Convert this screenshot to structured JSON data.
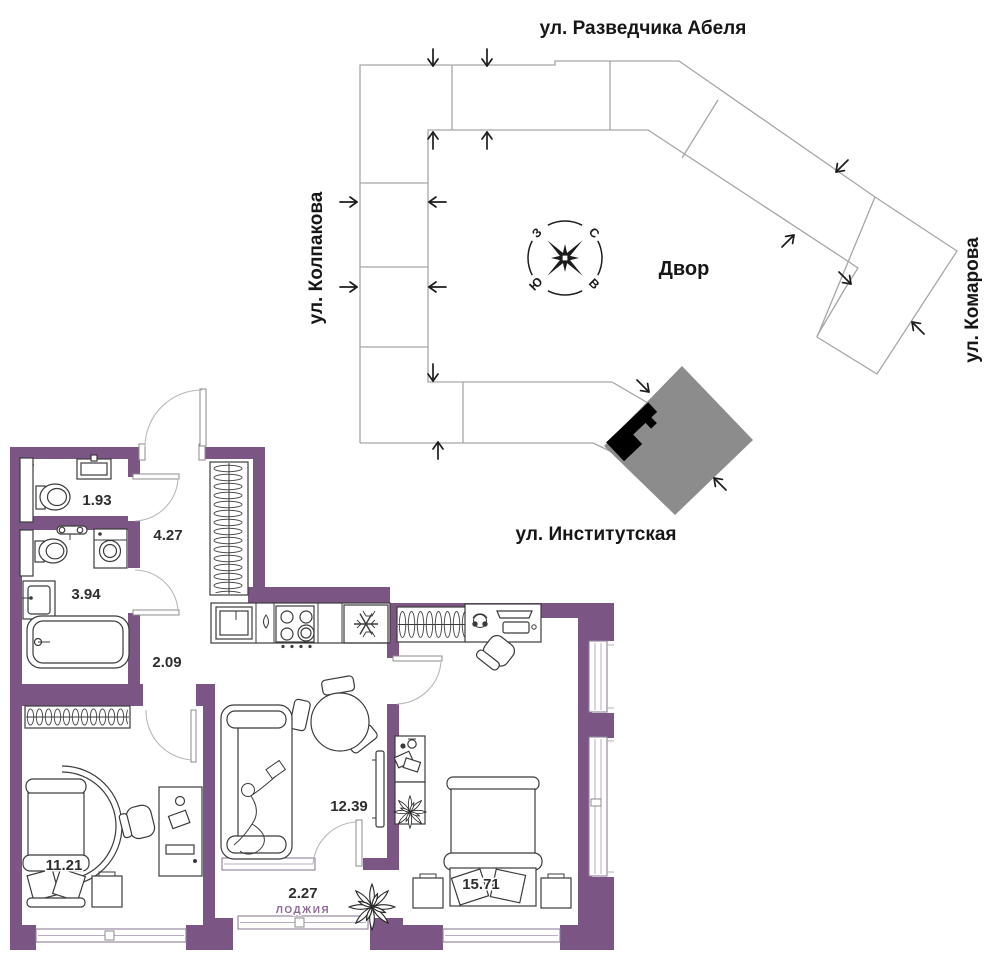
{
  "site_plan": {
    "streets": {
      "top": "ул. Разведчика Абеля",
      "left": "ул. Колпакова",
      "right": "ул. Комарова",
      "bottom": "ул. Институтская"
    },
    "courtyard_label": "Двор",
    "compass": {
      "north": "С",
      "south": "Ю",
      "west": "З",
      "east": "В"
    },
    "outline_color": "#a6a6a6",
    "highlighted_building_color": "#8c8c8c",
    "apartment_marker_color": "#000000"
  },
  "floor_plan": {
    "wall_color": "#7b5584",
    "loggia_label_color": "#8d6a97",
    "rooms": [
      {
        "id": "wc",
        "area": "1.93"
      },
      {
        "id": "hallway",
        "area": "4.27"
      },
      {
        "id": "bathroom",
        "area": "3.94"
      },
      {
        "id": "corridor",
        "area": "2.09"
      },
      {
        "id": "kitchen_living",
        "area": "12.39"
      },
      {
        "id": "bedroom",
        "area": "11.21"
      },
      {
        "id": "loggia",
        "area": "2.27",
        "name": "ЛОДЖИЯ"
      },
      {
        "id": "master_bedroom",
        "area": "15.71"
      }
    ]
  }
}
